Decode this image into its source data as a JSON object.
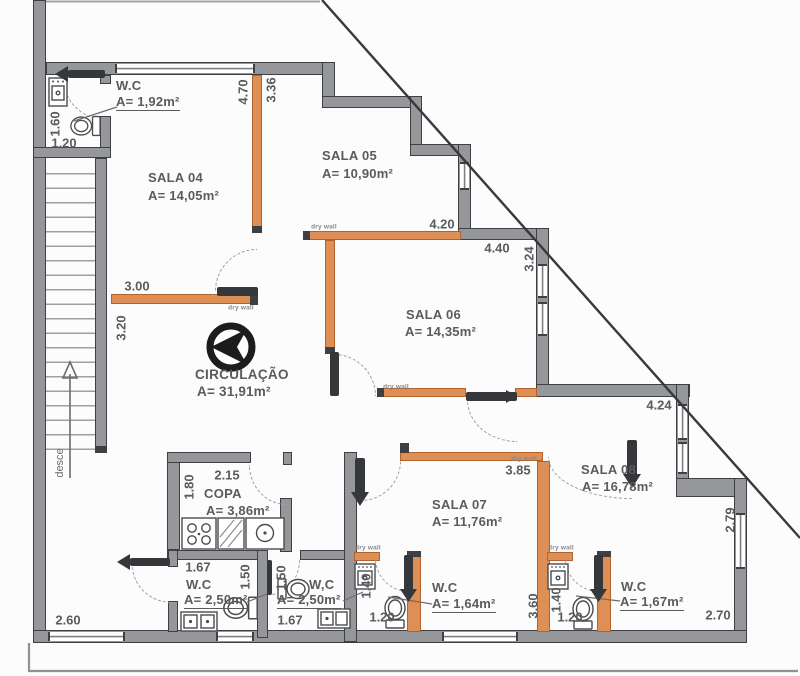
{
  "plan": {
    "rooms": {
      "wc_top": {
        "name": "W.C",
        "area": "A= 1,92m²"
      },
      "sala04": {
        "name": "SALA 04",
        "area": "A= 14,05m²"
      },
      "sala05": {
        "name": "SALA 05",
        "area": "A= 10,90m²"
      },
      "sala06": {
        "name": "SALA 06",
        "area": "A= 14,35m²"
      },
      "circulacao": {
        "name": "CIRCULAÇÃO",
        "area": "A= 31,91m²"
      },
      "copa": {
        "name": "COPA",
        "area": "A= 3,86m²"
      },
      "wc_left": {
        "name": "W.C",
        "area": "A= 2,50m²"
      },
      "wc_mid": {
        "name": "W,C",
        "area": "A= 2,50m²"
      },
      "sala07": {
        "name": "SALA 07",
        "area": "A= 11,76m²"
      },
      "wc_sala07": {
        "name": "W.C",
        "area": "A= 1,64m²"
      },
      "sala08": {
        "name": "SALA 08",
        "area": "A= 16,78m²"
      },
      "wc_sala08": {
        "name": "W.C",
        "area": "A= 1,67m²"
      }
    },
    "dims": {
      "v470": "4.70",
      "v336": "3.36",
      "v300": "3.00",
      "v320": "3.20",
      "v160": "1.60",
      "v120": "1.20",
      "v420": "4.20",
      "v440": "4.40",
      "v324": "3.24",
      "v424": "4.24",
      "v279": "2.79",
      "v270": "2.70",
      "v385": "3.85",
      "v360": "3.60",
      "v140": "1.40",
      "v180": "1.80",
      "v215": "2.15",
      "v167": "1.67",
      "v150": "1.50",
      "v260": "2.60"
    },
    "annotations": {
      "dry_wall": "dry wall",
      "desce": "desce"
    },
    "colors": {
      "wall_gray": "#95979a",
      "drywall_orange": "#dd8f55",
      "orange_border": "#b4622b",
      "line_dark": "#3d3f42",
      "text": "#595b5e"
    }
  }
}
